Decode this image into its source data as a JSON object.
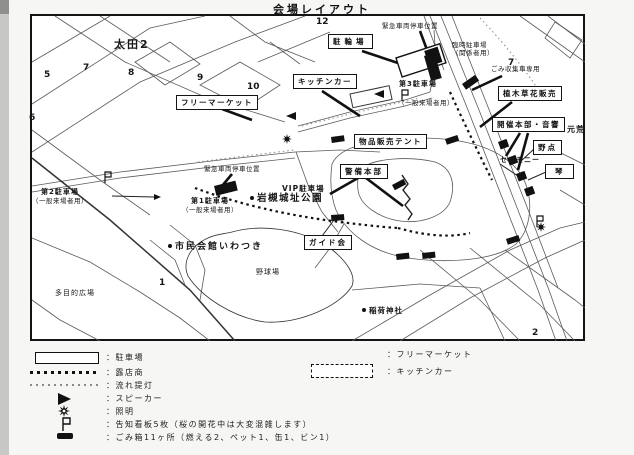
{
  "page": {
    "title": "会場レイアウト"
  },
  "map": {
    "labels": {
      "ota2": "太田2",
      "moto_arakawa": "元荒",
      "emergency_top": "緊急車両停車位置",
      "temp_parking_line1": "臨時駐車場",
      "temp_parking_line2": "（関係者用）",
      "garbage_truck": "ごみ収集車専用",
      "parking3": "第3駐車場",
      "parking3_note": "（一般来場者用）",
      "emergency_mid": "緊急車両停車位置",
      "parking1": "第1駐車場",
      "parking1_note": "（一般来場者用）",
      "parking2": "第2駐車場",
      "parking2_note": "（一般来場者用）",
      "vip_parking": "VIP駐車場",
      "iwatsuki_castle_park": "岩槻城址公園",
      "civic_hall": "市民会館いわつき",
      "baseball_field": "野球場",
      "multipurpose_plaza": "多目的広場",
      "inari_shrine": "稲荷神社",
      "ceremony": "セレモニー"
    },
    "boxes": {
      "flea_market": "フリーマーケット",
      "kitchen_car": "キッチンカー",
      "bicycle_parking": "駐輪場",
      "plant_flower_sales": "植木草花販売",
      "hq_audio": "開催本部・音響",
      "nodate": "野点",
      "koto": "琴",
      "goods_tent": "物品販売テント",
      "security_hq": "警備本部",
      "guide_society": "ガイド会"
    },
    "numbers": {
      "n1": "1",
      "n2": "2",
      "n5": "5",
      "n6": "6",
      "n7a": "7",
      "n7b": "7",
      "n8": "8",
      "n9": "9",
      "n10": "10",
      "n12": "12"
    }
  },
  "legend": {
    "left": [
      {
        "symbol": "parking-rect",
        "label": "：駐車場"
      },
      {
        "symbol": "bold-dashed-line",
        "label": "：露店商"
      },
      {
        "symbol": "light-dotted-line",
        "label": "：流れ提灯"
      },
      {
        "symbol": "speaker-triangle",
        "label": "：スピーカー"
      },
      {
        "symbol": "light-star",
        "label": "：照明"
      },
      {
        "symbol": "sign-flag",
        "label": "：告知看板5枚（桜の開花中は大変混雑します）"
      },
      {
        "symbol": "trash-bar",
        "label": "：ごみ箱11ヶ所（燃える2、ペット1、缶1、ビン1）"
      }
    ],
    "right": [
      {
        "symbol": "none",
        "label": "：フリーマーケット"
      },
      {
        "symbol": "dashed-rect",
        "label": "：キッチンカー"
      }
    ]
  },
  "colors": {
    "ink": "#141414",
    "road": "#5a5a5a",
    "paper": "#ffffff"
  }
}
